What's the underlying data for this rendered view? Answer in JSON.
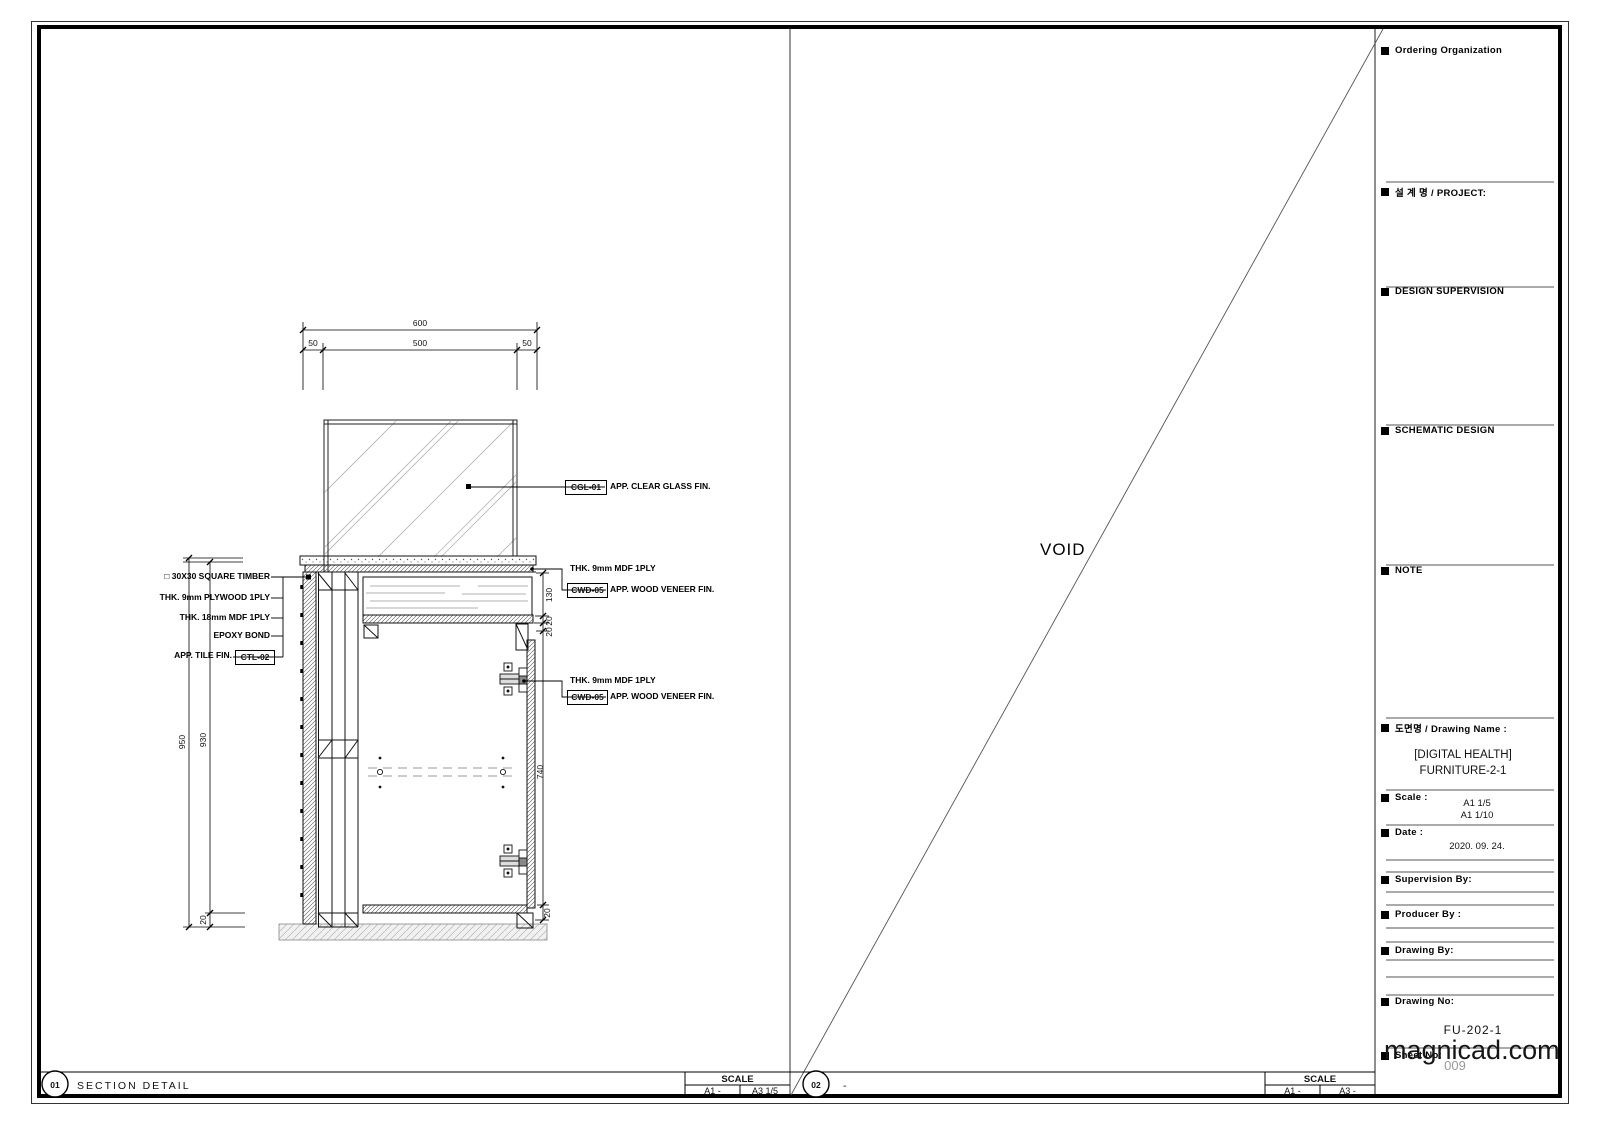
{
  "sheet": {
    "watermark": "magnicad.com",
    "panel1": {
      "number": "01",
      "title": "SECTION DETAIL",
      "scale_label": "SCALE",
      "scale_a1": "A1 -",
      "scale_a3": "A3 1/5"
    },
    "panel2": {
      "number": "02",
      "title": "-",
      "void_label": "VOID",
      "scale_label": "SCALE",
      "scale_a1": "A1 -",
      "scale_a3": "A3 -"
    },
    "titleblock": {
      "ordering_org": "Ordering Organization",
      "project": "설 계 명 / PROJECT:",
      "design_supervision": "DESIGN SUPERVISION",
      "schematic_design": "SCHEMATIC DESIGN",
      "note": "NOTE",
      "drawing_name_label": "도면명 / Drawing Name :",
      "drawing_name_line1": "[DIGITAL HEALTH]",
      "drawing_name_line2": "FURNITURE-2-1",
      "scale_label": "Scale :",
      "scale_value1": "A1 1/5",
      "scale_value2": "A1 1/10",
      "date_label": "Date :",
      "date_value": "2020. 09. 24.",
      "supervision_by": "Supervision By:",
      "producer_by": "Producer By :",
      "drawing_by": "Drawing By:",
      "drawing_no_label": "Drawing No:",
      "drawing_no_value": "FU-202-1",
      "sheet_no_label": "Sheet No:",
      "sheet_no_value": "009"
    }
  },
  "drawing": {
    "dims": {
      "top_total": "600",
      "top_left": "50",
      "top_center": "500",
      "top_right": "50",
      "height_total": "950",
      "height_body": "930",
      "base": "20",
      "upper": "130",
      "gap1": "20",
      "gap2": "20",
      "door": "740",
      "bottom": "20"
    },
    "labels_left": [
      "□ 30X30 SQUARE TIMBER",
      "THK. 9mm PLYWOOD 1PLY",
      "THK. 18mm MDF 1PLY",
      "EPOXY BOND",
      "APP. TILE FIN."
    ],
    "tag_ctl": "CTL-02",
    "labels_right": {
      "glass_tag": "CGL-01",
      "glass_text": "APP. CLEAR GLASS FIN.",
      "mdf_text": "THK. 9mm MDF 1PLY",
      "veneer_tag": "CWD-05",
      "veneer_text": "APP. WOOD VENEER FIN."
    }
  }
}
